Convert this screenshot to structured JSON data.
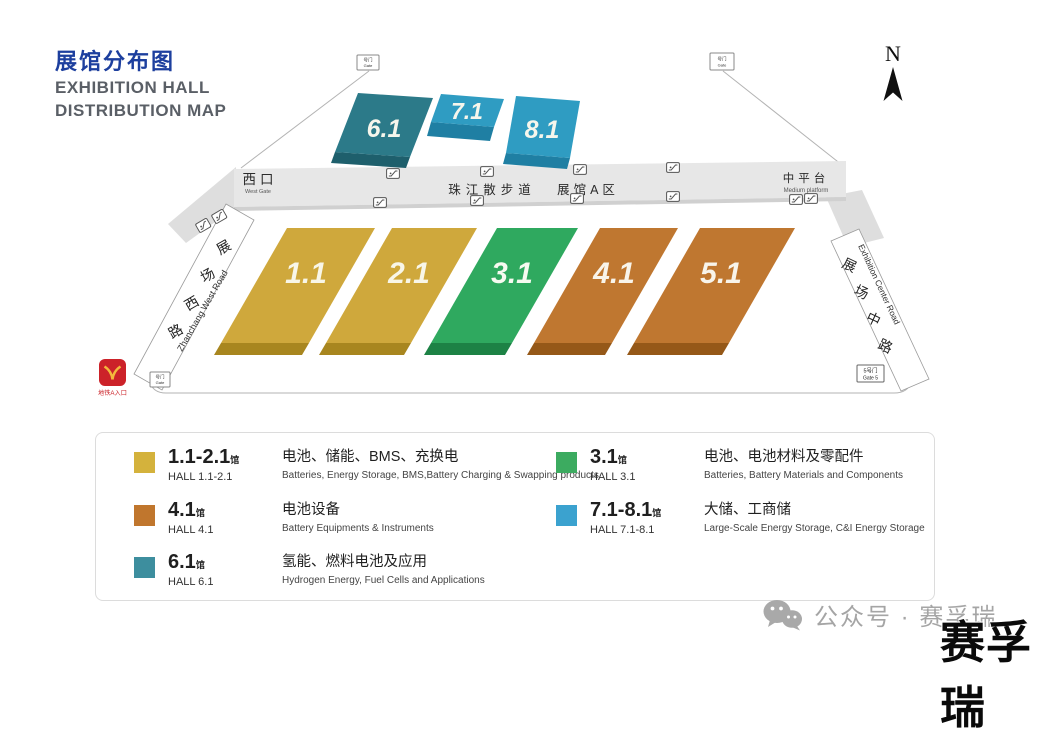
{
  "page": {
    "title_cn": "展馆分布图",
    "title_en_line1": "EXHIBITION HALL",
    "title_en_line2": "DISTRIBUTION MAP"
  },
  "compass": {
    "label": "N"
  },
  "map": {
    "halls": [
      {
        "number": "6.1",
        "color": "#2c7a89",
        "edge": "#1e5f6c"
      },
      {
        "number": "7.1",
        "color": "#2f9cc2",
        "edge": "#1f7fa3"
      },
      {
        "number": "8.1",
        "color": "#2f9cc2",
        "edge": "#1f7fa3"
      },
      {
        "number": "1.1",
        "color": "#cfa83c",
        "edge": "#a8861f"
      },
      {
        "number": "2.1",
        "color": "#cfa83c",
        "edge": "#a8861f"
      },
      {
        "number": "3.1",
        "color": "#2fa95f",
        "edge": "#1d8245"
      },
      {
        "number": "4.1",
        "color": "#bf7730",
        "edge": "#955818"
      },
      {
        "number": "5.1",
        "color": "#bf7730",
        "edge": "#955818"
      }
    ],
    "corridor": {
      "west_gate_cn": "西口",
      "west_gate_en": "West Gate",
      "promenade": "珠江散步道",
      "area_a": "展馆A区",
      "platform_cn": "中平台",
      "platform_en": "Medium platform"
    },
    "roads": {
      "west_cn": "展场西路",
      "west_en": "Zhanchang West Road",
      "center_cn": "展场中路",
      "center_en": "Exhibition Center Road"
    },
    "gates": {
      "generic_cn": "号门",
      "generic_en": "Gate",
      "gate5_cn": "5号门",
      "gate5_en": "Gate 5"
    },
    "metro": {
      "label": "地铁A入口"
    }
  },
  "legend": {
    "items": [
      {
        "range": "1.1-2.1",
        "suffix": "馆",
        "hall": "HALL 1.1-2.1",
        "cn": "电池、储能、BMS、充换电",
        "en": "Batteries, Energy Storage, BMS,Battery Charging & Swapping products",
        "color": "#d4b23c"
      },
      {
        "range": "4.1",
        "suffix": "馆",
        "hall": "HALL 4.1",
        "cn": "电池设备",
        "en": "Battery Equipments & Instruments",
        "color": "#c0762d"
      },
      {
        "range": "6.1",
        "suffix": "馆",
        "hall": "HALL 6.1",
        "cn": "氢能、燃料电池及应用",
        "en": "Hydrogen Energy, Fuel Cells and Applications",
        "color": "#3d8e9e"
      },
      {
        "range": "3.1",
        "suffix": "馆",
        "hall": "HALL 3.1",
        "cn": "电池、电池材料及零配件",
        "en": "Batteries, Battery Materials and Components",
        "color": "#3cab60"
      },
      {
        "range": "7.1-8.1",
        "suffix": "馆",
        "hall": "HALL 7.1-8.1",
        "cn": "大储、工商储",
        "en": "Large-Scale Energy Storage, C&I Energy Storage",
        "color": "#3ba2cf"
      }
    ]
  },
  "watermark": {
    "wechat": "公众号 · 赛孚瑞",
    "brand": "赛孚瑞"
  }
}
